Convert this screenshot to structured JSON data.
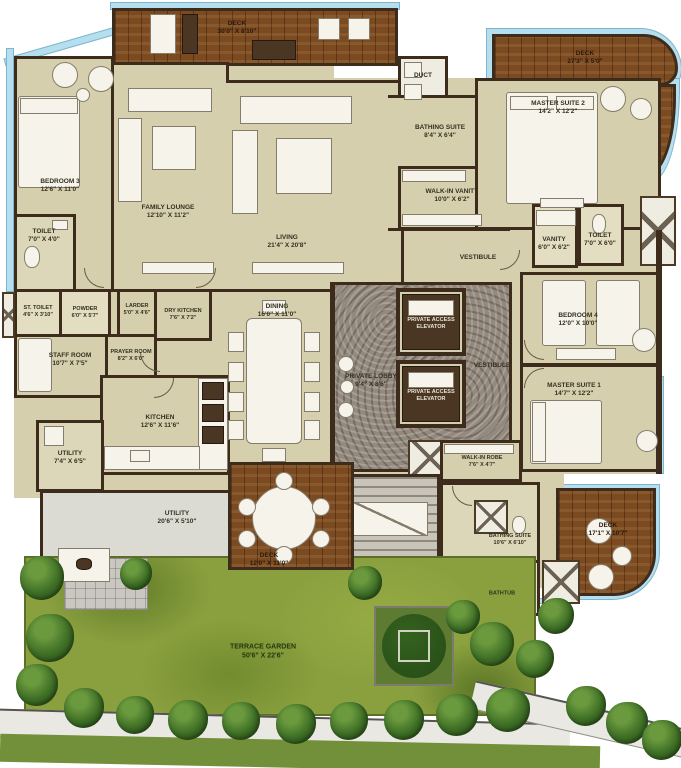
{
  "palette": {
    "wall": "#3d2b1b",
    "floor": "#d6cfae",
    "wood_deck": "#7c4a21",
    "glass": "#b5dfee",
    "garden": "#8aa03f",
    "stone_lobby": "#94897d"
  },
  "rooms": {
    "deck_top": {
      "name": "DECK",
      "dims": "30'0\" X 8'10\""
    },
    "bedroom3": {
      "name": "BEDROOM 3",
      "dims": "12'6\" X 11'0\""
    },
    "toilet_bed3": {
      "name": "TOILET",
      "dims": "7'0\" X 4'0\""
    },
    "family_lounge": {
      "name": "FAMILY LOUNGE",
      "dims": "12'10\" X 11'2\""
    },
    "living": {
      "name": "LIVING",
      "dims": "21'4\" X 20'8\""
    },
    "duct": {
      "name": "DUCT"
    },
    "bathing_suite2": {
      "name": "BATHING SUITE",
      "dims": "8'4\" X 6'4\""
    },
    "walkin_vanity": {
      "name": "WALK-IN VANITY",
      "dims": "10'0\" X 6'2\""
    },
    "deck_top_right": {
      "name": "DECK",
      "dims": "27'3\" X 5'0\""
    },
    "master_suite2": {
      "name": "MASTER SUITE 2",
      "dims": "14'2\" X 12'2\""
    },
    "vanity2": {
      "name": "VANITY",
      "dims": "6'0\" X 6'2\""
    },
    "toilet2": {
      "name": "TOILET",
      "dims": "7'0\" X 6'0\""
    },
    "vestibule_top": {
      "name": "VESTIBULE"
    },
    "bedroom4": {
      "name": "BEDROOM 4",
      "dims": "12'0\" X 10'0\""
    },
    "vestibule_mid": {
      "name": "VESTIBULE"
    },
    "master_suite1": {
      "name": "MASTER SUITE 1",
      "dims": "14'7\" X 12'2\""
    },
    "st_toilet": {
      "name": "ST. TOILET",
      "dims": "4'6\" X 3'10\""
    },
    "powder": {
      "name": "POWDER",
      "dims": "6'0\" X 5'7\""
    },
    "larder": {
      "name": "LARDER",
      "dims": "5'0\" X 4'6\""
    },
    "dry_kitchen": {
      "name": "DRY KITCHEN",
      "dims": "7'6\" X 7'2\""
    },
    "prayer_room": {
      "name": "PRAYER ROOM",
      "dims": "8'2\" X 6'0\""
    },
    "staff_room": {
      "name": "STAFF ROOM",
      "dims": "10'7\" X 7'5\""
    },
    "dining": {
      "name": "DINING",
      "dims": "16'0\" X 11'0\""
    },
    "private_lobby": {
      "name": "PRIVATE LOBBY",
      "dims": "9'4\" X 8'6\""
    },
    "elevator1": {
      "name": "PRIVATE ACCESS",
      "name2": "ELEVATOR"
    },
    "elevator2": {
      "name": "PRIVATE ACCESS",
      "name2": "ELEVATOR"
    },
    "kitchen": {
      "name": "KITCHEN",
      "dims": "12'6\" X 11'6\""
    },
    "utility1": {
      "name": "UTILITY",
      "dims": "7'4\" X 6'5\""
    },
    "utility2": {
      "name": "UTILITY",
      "dims": "20'6\" X 5'10\""
    },
    "deck_dining": {
      "name": "DECK",
      "dims": "12'0\" X 11'0\""
    },
    "walkin_robe": {
      "name": "WALK-IN ROBE",
      "dims": "7'6\" X 4'7\""
    },
    "bathing_suite1": {
      "name": "BATHING SUITE",
      "dims": "10'6\" X 6'10\""
    },
    "bathtub": {
      "name": "BATHTUB"
    },
    "deck_bottom_right": {
      "name": "DECK",
      "dims": "17'1\" X 10'7\""
    },
    "terrace_garden": {
      "name": "TERRACE GARDEN",
      "dims": "50'6\" X 22'6\""
    }
  }
}
